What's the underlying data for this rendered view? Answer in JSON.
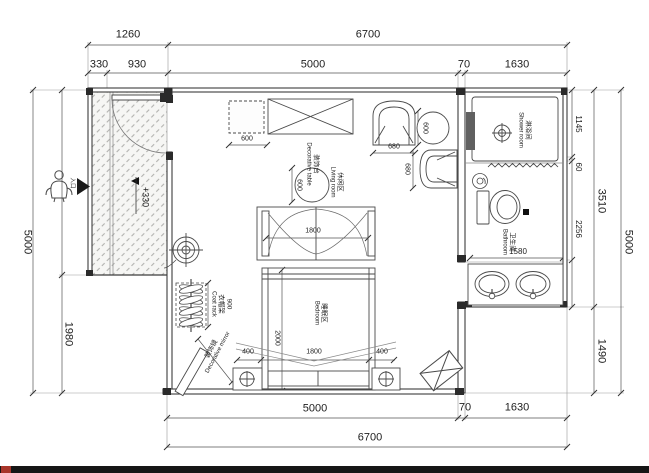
{
  "canvas": {
    "bg": "#ffffff",
    "line_color": "#3c3c3c",
    "dim_color": "#555555",
    "bar_color": "#161616",
    "chip_color": "#a8352a"
  },
  "rooms": {
    "shower": {
      "cn": "淋浴间",
      "en": "Shower room"
    },
    "bathroom": {
      "cn": "卫生间",
      "en": "Bathroom"
    },
    "living": {
      "cn": "休闲区",
      "en": "Living room"
    },
    "bedroom": {
      "cn": "睡眠区",
      "en": "Bedroom"
    }
  },
  "furniture": {
    "coat_rack": {
      "cn": "衣帽架",
      "en": "Coat rack"
    },
    "decorative_mirror": {
      "cn": "装饰镜",
      "en": "Decorative mirror"
    },
    "decorative_table": {
      "cn": "装饰台",
      "en": "Decorative table"
    }
  },
  "annotations": {
    "entry_level": "+330",
    "entrance": "入口"
  },
  "dims": {
    "top": {
      "porch_total": "1260",
      "overall": "6700",
      "porch_a": "330",
      "porch_b": "930",
      "main": "5000",
      "wall": "70",
      "bath": "1630"
    },
    "bottom": {
      "main": "5000",
      "wall": "70",
      "bath": "1630",
      "overall": "6700"
    },
    "left": {
      "overall": "5000",
      "lower": "1980"
    },
    "right": {
      "shower": "1145",
      "gap": "60",
      "bath": "2256",
      "upper": "3510",
      "lower": "1490",
      "overall": "5000"
    },
    "interior": {
      "cabinet_width": "600",
      "decor_table_dia": "600",
      "side_table_dia": "600",
      "armchair_width": "680",
      "armchair_depth": "680",
      "canopy_width": "1800",
      "bed_length": "2000",
      "bed_margin_left": "400",
      "bed_width": "1800",
      "bed_margin_right": "400",
      "coat_rack_length": "900",
      "bathroom_width": "1580"
    }
  }
}
